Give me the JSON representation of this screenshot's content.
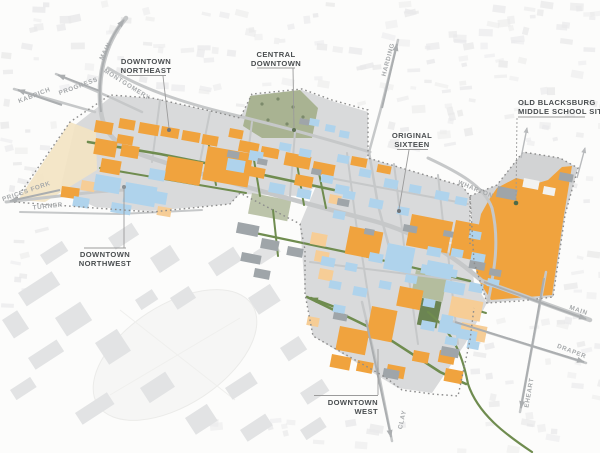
{
  "districts": {
    "dne": {
      "line1": "DOWNTOWN",
      "line2": "NORTHEAST"
    },
    "cd": {
      "line1": "CENTRAL",
      "line2": "DOWNTOWN"
    },
    "dnw": {
      "line1": "DOWNTOWN",
      "line2": "NORTHWEST"
    },
    "os": {
      "line1": "ORIGINAL",
      "line2": "SIXTEEN"
    },
    "obms": {
      "line1": "OLD BLACKSBURG",
      "line2": "MIDDLE SCHOOL SITE"
    },
    "dw": {
      "line1": "DOWNTOWN",
      "line2": "WEST"
    }
  },
  "streets": {
    "main_north": "MAIN",
    "progress": "PROGRESS",
    "kabrich": "KABRICH",
    "montgomery": "MONTGOMERY",
    "prices_fork": "PRICES FORK",
    "turner": "TURNER",
    "harding": "HARDING",
    "wharton": "WHARTON",
    "main_south": "MAIN",
    "draper": "DRAPER",
    "eheart": "EHEART",
    "clay": "CLAY"
  },
  "colors": {
    "building_orange": "#F0A33E",
    "building_orange_light": "#F6CD96",
    "building_blue": "#AFD3EC",
    "building_gray": "#9FA5A9",
    "district_gray": "#D9DADB",
    "school_gray": "#D2D3D4",
    "road_gray": "#C6C8C9",
    "street_green": "#6F8C4F",
    "park_green": "#A9B392",
    "sage_green": "#B5BEA1",
    "tan_area": "#F3E4C3",
    "boundary_gray": "#8C8C8C",
    "label_dark": "#4A4E50",
    "street_label": "#A6A9AB",
    "leader_gray": "#9B9B9B",
    "dot_green": "#4E6B48",
    "dot_gray": "#70757A",
    "campus_gray": "#E2E3E4",
    "fabric_gray": "#E9E9EA"
  }
}
